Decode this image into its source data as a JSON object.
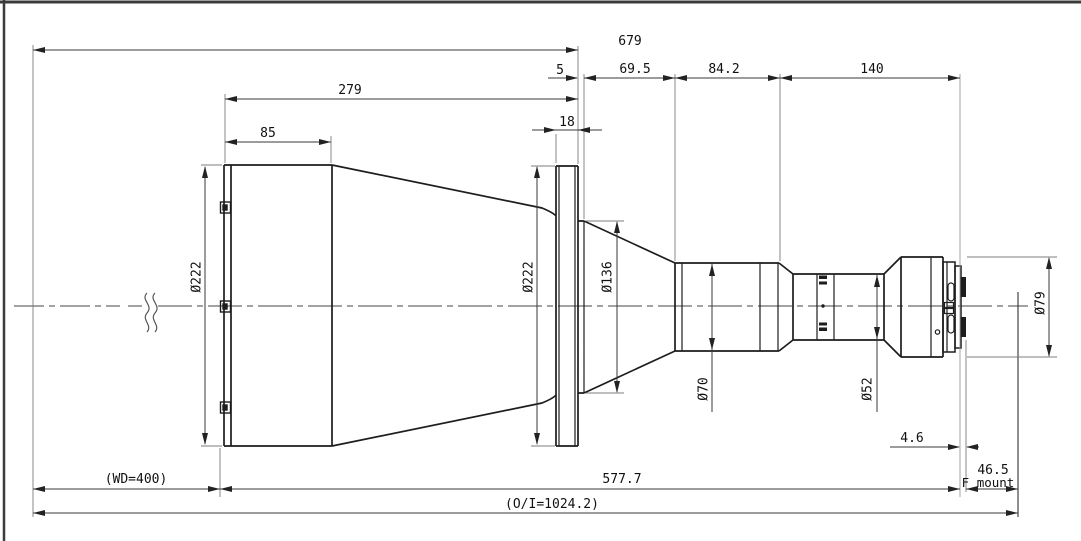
{
  "drawing": {
    "type": "engineering-outline-drawing",
    "subject": "large telecentric lens mechanical outline",
    "top_dims": {
      "overall": "679",
      "to_flange": "279",
      "front_section": "85",
      "flange_step": "5",
      "flange_thickness": "18",
      "relay_section": "69.5",
      "cone_section": "84.2",
      "rear_section": "140"
    },
    "diameters": {
      "front_cell": "Ø222",
      "flange": "Ø222",
      "relay_cone": "Ø136",
      "mid_barrel": "Ø70",
      "rear_barrel": "Ø52",
      "mount_ring": "Ø79"
    },
    "bottom_dims": {
      "working_distance": "(WD=400)",
      "mechanical_length": "577.7",
      "flange_offset": "4.6",
      "flange_focal_distance": "46.5",
      "mount_type": "F mount",
      "object_image_distance": "(O/I=1024.2)"
    }
  }
}
